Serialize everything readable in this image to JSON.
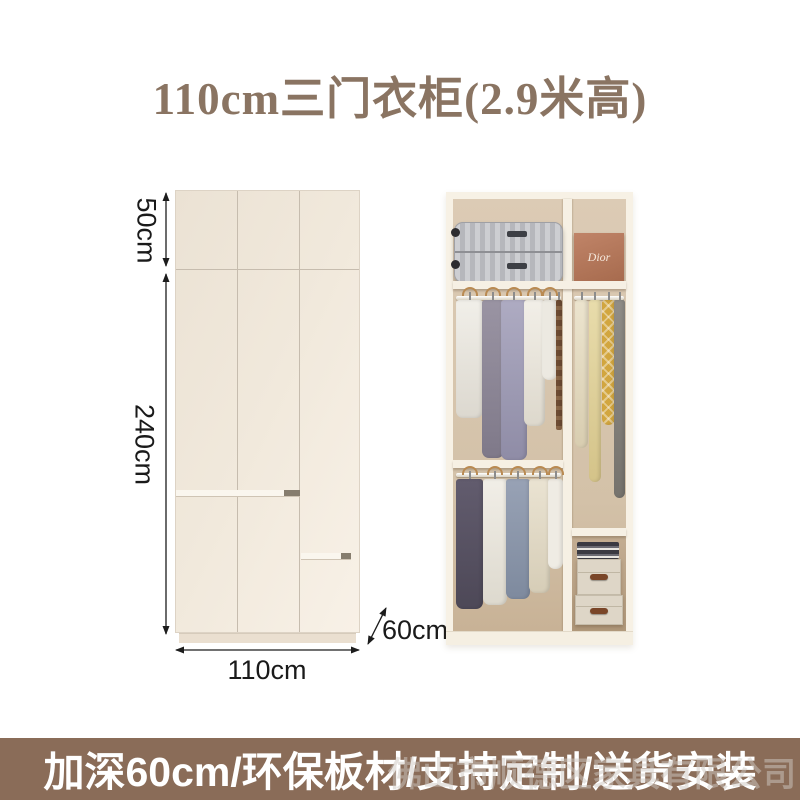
{
  "title": {
    "text": "110cm三门衣柜(2.9米高)",
    "color": "#8a7462"
  },
  "diagram": {
    "labels": {
      "top_height": "50cm",
      "main_height": "240cm",
      "width": "110cm",
      "depth": "60cm"
    },
    "colors": {
      "door_face": "#f1e9dc",
      "seam": "#c6bcae",
      "plinth": "#eadfd0",
      "dimension_line": "#1c1c1c"
    }
  },
  "photo": {
    "dior_box_label": "Dior",
    "colors": {
      "frame": "#f7f1e5",
      "back_wall": "#d9c8b2",
      "suitcase": "#c0c1c5",
      "dior_box": "#b5795d",
      "storage_box": "#ded6c7",
      "handle_leather": "#7a4628",
      "hanger_wood": "#b98a52"
    }
  },
  "banner": {
    "text": "加深60cm/环保板材/支持定制/送货安装",
    "background": "#8a6c58",
    "text_color": "#ffffff",
    "watermark_text": "佛山市顺德区家具有限公司"
  }
}
